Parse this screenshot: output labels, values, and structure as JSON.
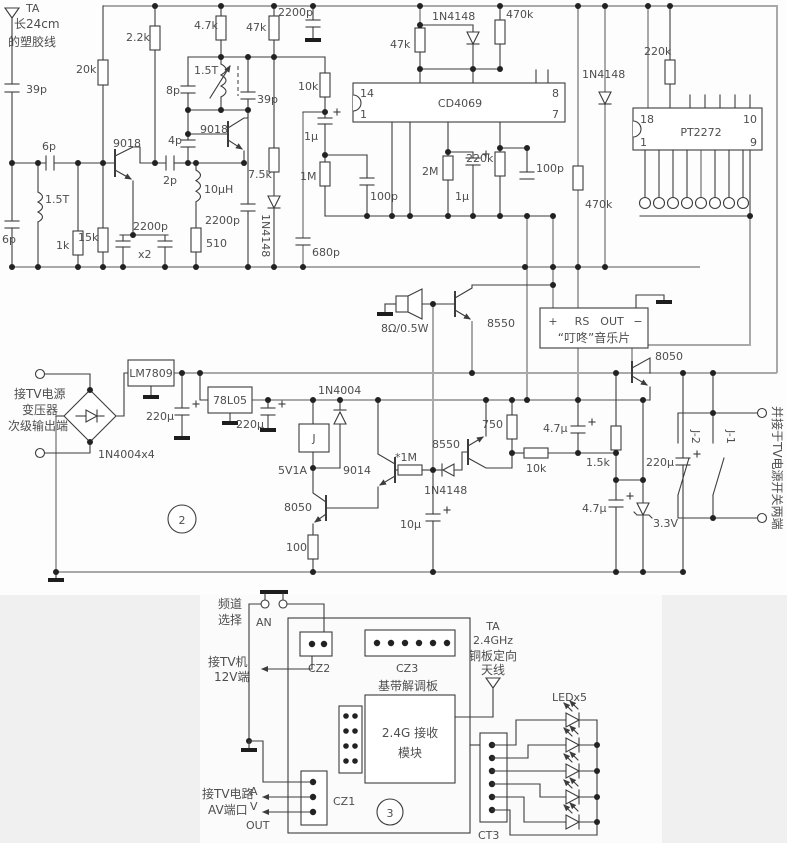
{
  "accent_colors": {
    "wire_dark": "#3c3c3c",
    "wire_gray": "#a9a9a9",
    "panel_gray": "#f0f0f0"
  },
  "s1": {
    "ta": "TA",
    "ant_l1": "长24cm",
    "ant_l2": "的塑胶线",
    "c39p_a": "39p",
    "c6p_a": "6p",
    "l15t_a": "1.5T",
    "c6p_b": "6p",
    "r1k": "1k",
    "r15k": "15k",
    "r20k": "20k",
    "r2k2": "2.2k",
    "q9018_a": "9018",
    "c2200p_a": "2200p",
    "x2": "x2",
    "c2p": "2p",
    "l10uh": "10µH",
    "r510": "510",
    "c2200p_b": "2200p",
    "c8p": "8p",
    "l15t_b": "1.5T",
    "c4p": "4p",
    "q9018_b": "9018",
    "c39p_b": "39p",
    "r7k5": "7.5k",
    "d4148_a": "1N4148",
    "r4k7": "4.7k",
    "r47k_a": "47k",
    "c2200p_c": "2200p",
    "r47k_b": "47k",
    "d4148_b": "1N4148",
    "r470k_a": "470k",
    "r10k": "10k",
    "c1u_a": "1µ",
    "r1m": "1M",
    "c100p_a": "100p",
    "c680p": "680p",
    "ic1": "CD4069",
    "ic1_p14": "14",
    "ic1_p1": "1",
    "ic1_p8": "8",
    "ic1_p7": "7",
    "r2m": "2M",
    "c1u_b": "1µ",
    "r220k_a": "220k",
    "c100p_b": "100p",
    "r470k_b": "470k",
    "d4148_c": "1N4148",
    "r220k_b": "220k",
    "ic2": "PT2272",
    "ic2_p18": "18",
    "ic2_p1": "1",
    "ic2_p10": "10",
    "ic2_p9": "9",
    "spk": "8Ω/0.5W",
    "q8550_a": "8550",
    "m_plus": "+",
    "m_rs": "RS",
    "m_out": "OUT",
    "m_minus": "−",
    "music": "“叮咚”音乐片",
    "q8050_b": "8050"
  },
  "s2": {
    "in_l1": "接TV电源",
    "in_l2": "变压器",
    "in_l3": "次级输出端",
    "bridge": "1N4004x4",
    "reg1": "LM7809",
    "c220u_a": "220µ",
    "reg2": "78L05",
    "c220u_b": "220µ",
    "num": "2",
    "d4004": "1N4004",
    "relay": "J",
    "relay_r": "5V1A",
    "q9014": "9014",
    "r1m_s": "*1M",
    "d4148_d": "1N4148",
    "q8550_b": "8550",
    "r750": "750",
    "c10u": "10µ",
    "q8050_a": "8050",
    "r100": "100",
    "r10k": "10k",
    "c4u7_a": "4.7µ",
    "r1k5": "1.5k",
    "c220u_c": "220µ",
    "c4u7_b": "4.7µ",
    "dz": "3.3V",
    "j1": "J-1",
    "j2": "J-2",
    "note": "并接于TV电源开关两端"
  },
  "s3": {
    "num": "3",
    "ch_l1": "频道",
    "ch_l2": "选择",
    "an": "AN",
    "tv12_l1": "接TV机",
    "tv12_l2": "12V端",
    "cz2": "CZ2",
    "cz3": "CZ3",
    "board": "基带解调板",
    "mod_l1": "2.4G 接收",
    "mod_l2": "模块",
    "cz1": "CZ1",
    "av_l1": "接TV电路",
    "av_l2": "AV端口",
    "a": "A",
    "v": "V",
    "out": "OUT",
    "ta": "TA",
    "ant_l1": "2.4GHz",
    "ant_l2": "铜板定向",
    "ant_l3": "天线",
    "led": "LEDx5",
    "ct3": "CT3"
  }
}
